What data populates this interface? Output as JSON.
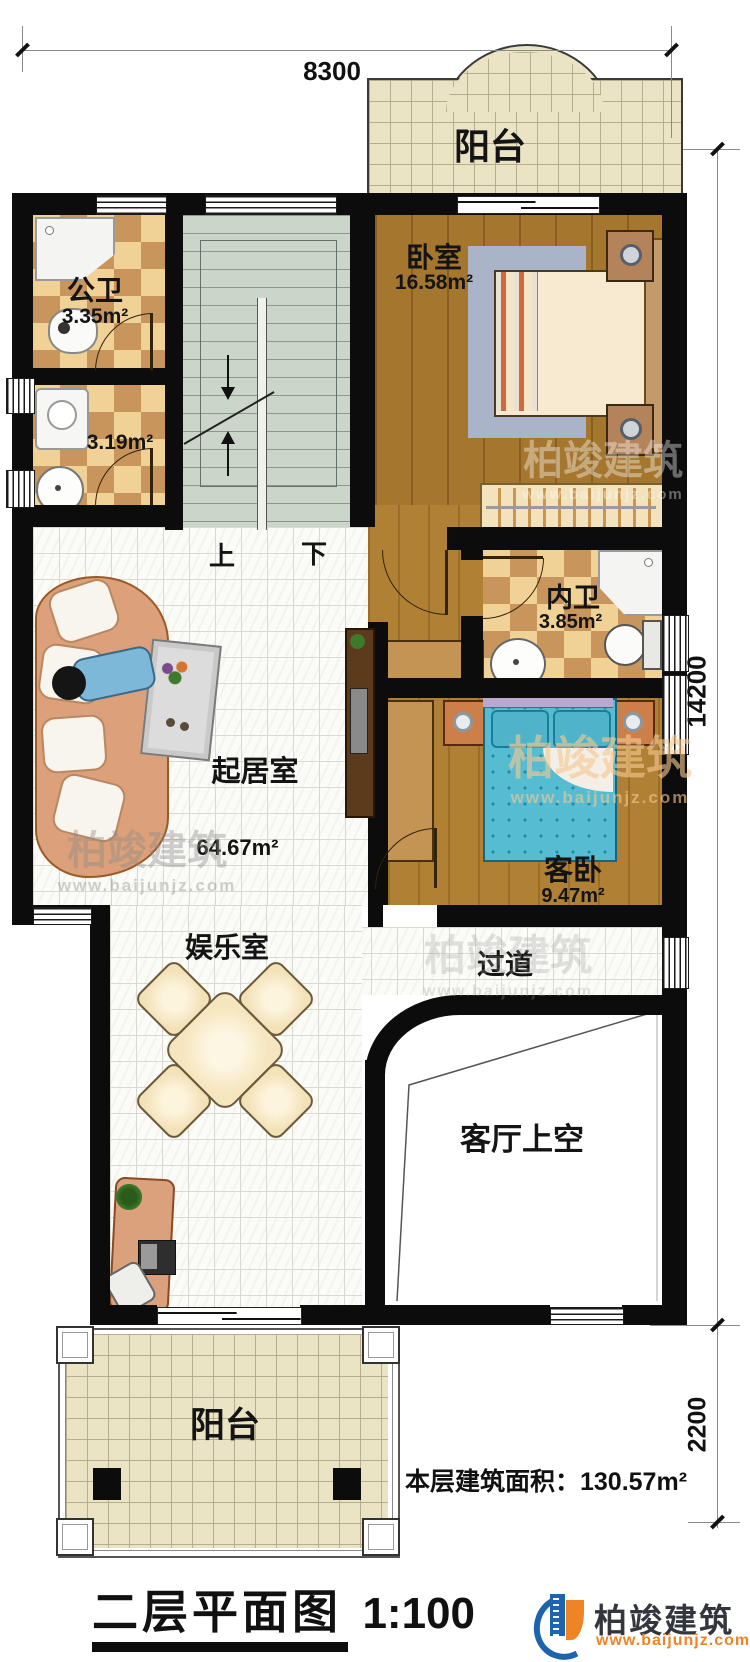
{
  "brand": {
    "name": "柏竣建筑",
    "site": "www.baijunjz.com"
  },
  "title": {
    "text": "二层平面图",
    "scale": "1:100"
  },
  "note": {
    "floor_area": "本层建筑面积：130.57m²"
  },
  "dimensions": {
    "top": "8300",
    "right_upper": "14200",
    "right_lower": "2200"
  },
  "stairs": {
    "up": "上",
    "down": "下"
  },
  "rooms": {
    "balcony_top": {
      "name": "阳台"
    },
    "public_bath": {
      "name": "公卫",
      "area": "3.35m²"
    },
    "laundry": {
      "area": "3.19m²"
    },
    "bedroom": {
      "name": "卧室",
      "area": "16.58m²"
    },
    "inner_bath": {
      "name": "内卫",
      "area": "3.85m²"
    },
    "living": {
      "name": "起居室",
      "area": "64.67m²"
    },
    "guest_bedroom": {
      "name": "客卧",
      "area": "9.47m²"
    },
    "entertainment": {
      "name": "娱乐室"
    },
    "corridor": {
      "name": "过道"
    },
    "living_void": {
      "name": "客厅上空"
    },
    "balcony_bottom": {
      "name": "阳台"
    }
  },
  "colors": {
    "wall": "#0c0c0c",
    "checker_tile": "#c8955c",
    "wood_floor": "#a5772e",
    "stair_floor": "#ccd5ca",
    "balcony_tile": "#eae3c4",
    "logo_blue": "#1c64ad",
    "logo_orange": "#ef8426"
  }
}
